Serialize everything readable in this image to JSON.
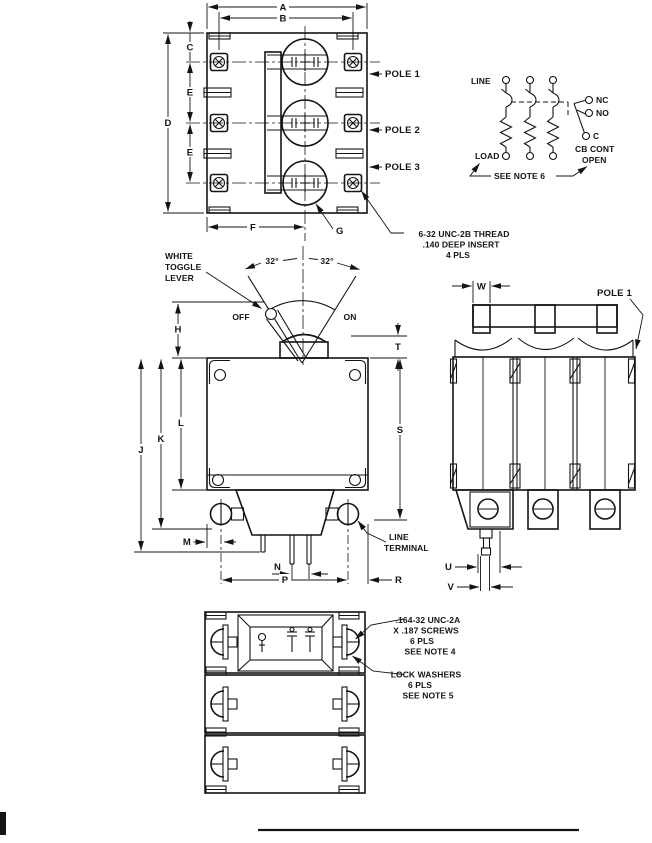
{
  "top_view": {
    "dim_a": "A",
    "dim_b": "B",
    "dim_c": "C",
    "dim_d": "D",
    "dim_e1": "E",
    "dim_e2": "E",
    "dim_f": "F",
    "dim_g": "G",
    "pole1": "POLE 1",
    "pole2": "POLE 2",
    "pole3": "POLE 3",
    "thread_note": [
      "6-32 UNC-2B THREAD",
      ".140 DEEP INSERT",
      "4 PLS"
    ]
  },
  "schematic": {
    "line": "LINE",
    "load": "LOAD",
    "nc": "NC",
    "no": "NO",
    "c": "C",
    "cb_cont_line1": "CB CONT",
    "cb_cont_line2": "OPEN",
    "see_note": "SEE NOTE 6"
  },
  "front_view": {
    "toggle_note": [
      "WHITE",
      "TOGGLE",
      "LEVER"
    ],
    "off": "OFF",
    "on": "ON",
    "angle_left": "32°",
    "angle_right": "32°",
    "dim_h": "H",
    "dim_t": "T",
    "dim_s": "S",
    "dim_j": "J",
    "dim_k": "K",
    "dim_l": "L",
    "dim_m": "M",
    "dim_n": "N",
    "dim_p": "P",
    "dim_r": "R",
    "line_terminal": [
      "LINE",
      "TERMINAL"
    ]
  },
  "side_view": {
    "dim_w": "W",
    "dim_u": "U",
    "dim_v": "V",
    "pole1": "POLE 1"
  },
  "bottom_view": {
    "screw_note": [
      ".164-32 UNC-2A",
      "X .187 SCREWS",
      "6 PLS",
      "SEE NOTE 4"
    ],
    "washer_note": [
      "LOCK WASHERS",
      "6 PLS",
      "SEE NOTE 5"
    ]
  }
}
